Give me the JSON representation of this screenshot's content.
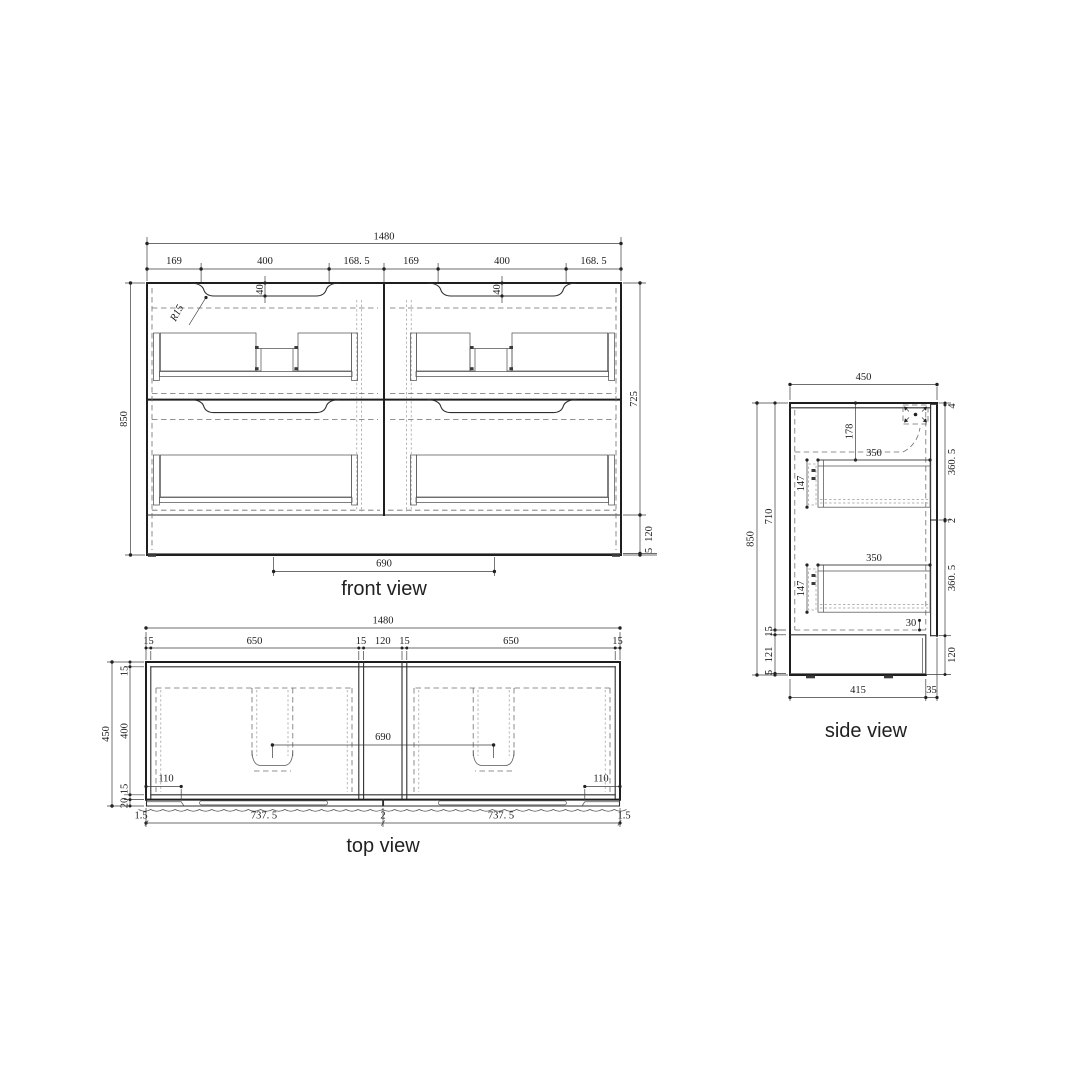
{
  "front_view": {
    "label": "front view",
    "overall_width": "1480",
    "segments": [
      "169",
      "400",
      "168. 5",
      "169",
      "400",
      "168. 5"
    ],
    "height": "850",
    "handle_depth": "40",
    "corner_radius": "R15",
    "body_height": "725",
    "plinth_height": "120",
    "bottom_edge": "5",
    "drain_spacing": "690"
  },
  "top_view": {
    "label": "top view",
    "overall_width": "1480",
    "segments": [
      "15",
      "650",
      "15",
      "120",
      "15",
      "650",
      "15"
    ],
    "depth": "450",
    "top_wall": "15",
    "interior_depth": "400",
    "front_wall": "15",
    "door_thickness": "20",
    "corner_offset": "110",
    "drain_spacing": "690",
    "bottom_segments": [
      "1.5",
      "737. 5",
      "2",
      "737. 5",
      "1.5"
    ]
  },
  "side_view": {
    "label": "side view",
    "depth": "450",
    "height": "850",
    "interior_height": "710",
    "top_gap": "4",
    "drawer_front_height": "360. 5",
    "front_gap": "2",
    "plinth_height": "120",
    "drawer_top_offset": "178",
    "drawer_depth": "350",
    "drawer_height": "147",
    "bottom_clearance": "30",
    "bottom_wall": "15",
    "plinth_inner": "121",
    "bottom_edge": "5",
    "base_depth": "415",
    "toe_recess": "35"
  }
}
